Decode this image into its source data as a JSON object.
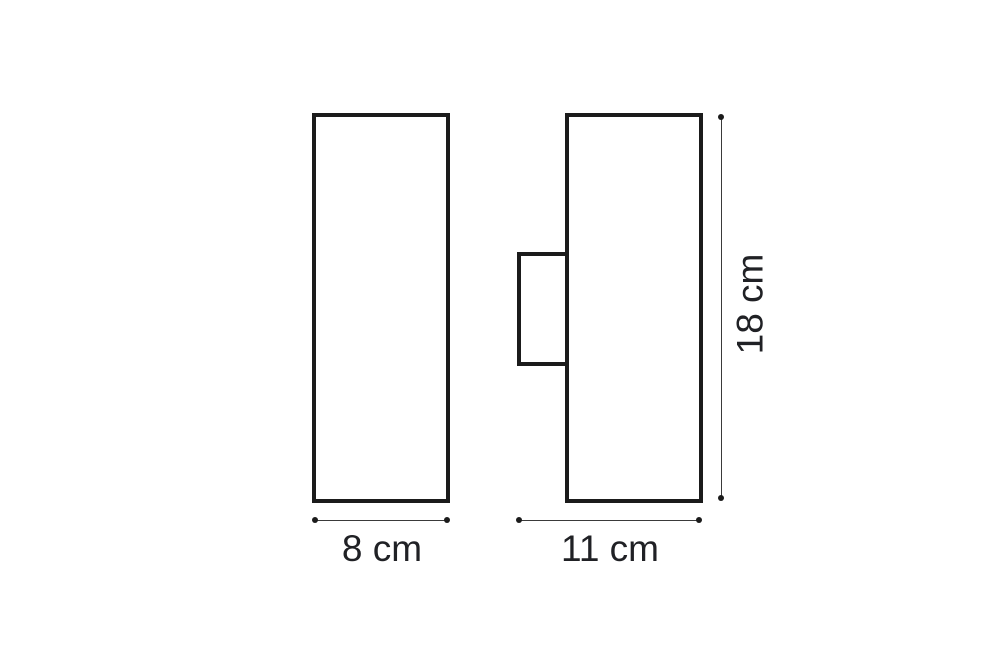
{
  "diagram": {
    "kind": "product-dimension-drawing",
    "front_view": {
      "width_label": "8 cm"
    },
    "side_view": {
      "width_label": "11 cm",
      "height_label": "18 cm"
    },
    "colors": {
      "background": "#ffffff",
      "outline": "#1b1b1b",
      "dimension_line": "#3a3a3a",
      "label_text": "#202125"
    }
  }
}
